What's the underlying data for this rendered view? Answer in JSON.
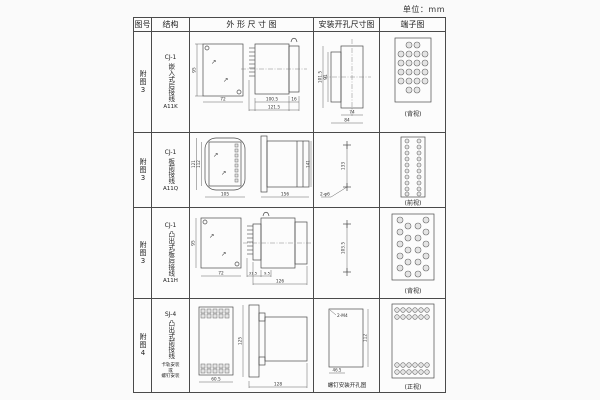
{
  "symbols": {
    "diag_arrow": "↗"
  },
  "unit_label": "单位：mm",
  "table": {
    "headers": {
      "fig": "图号",
      "structure": "结构",
      "outline": "外 形 尺 寸 图",
      "install": "安装开孔尺寸图",
      "terminal": "端子图"
    },
    "rows": [
      {
        "fig": "附图3",
        "model": "CJ-1",
        "desc": "嵌入式后接线",
        "code": "A11K",
        "dims": {
          "front_h": "95",
          "front_w": "72",
          "side_a": "100.5",
          "side_b": "16",
          "side_total": "121.5",
          "inst_v1": "101.5",
          "inst_v2": "91",
          "inst_h1": "74",
          "inst_h2": "84"
        },
        "view_caption": "(背视)"
      },
      {
        "fig": "附图3",
        "model": "CJ-1",
        "desc": "板前接线",
        "code": "A11Q",
        "dims": {
          "front_h1": "121",
          "front_h2": "112",
          "front_w": "105",
          "side_total": "156",
          "side_h": "141",
          "inst_v": "133",
          "inst_hole": "2-φ6"
        },
        "view_caption": "(前视)"
      },
      {
        "fig": "附图3",
        "model": "CJ-1",
        "desc": "凸出式板后接线",
        "code": "A11H",
        "dims": {
          "front_h": "95",
          "front_w": "72",
          "side_a": "31.5",
          "side_b": "9.5",
          "side_total": "126",
          "inst_v": "103.5"
        },
        "view_caption": "(背视)"
      },
      {
        "fig": "附图4",
        "model": "SJ-4",
        "desc": "凸出式前接线",
        "note1": "卡轨安装",
        "note2": "或",
        "note3": "螺钉安装",
        "dims": {
          "front_w": "60.5",
          "side_h": "125",
          "side_total": "128",
          "inst_screw": "2-M4",
          "inst_w": "46.5",
          "inst_h": "112"
        },
        "inst_caption": "螺钉安装开孔图",
        "view_caption": "(正视)"
      }
    ]
  }
}
